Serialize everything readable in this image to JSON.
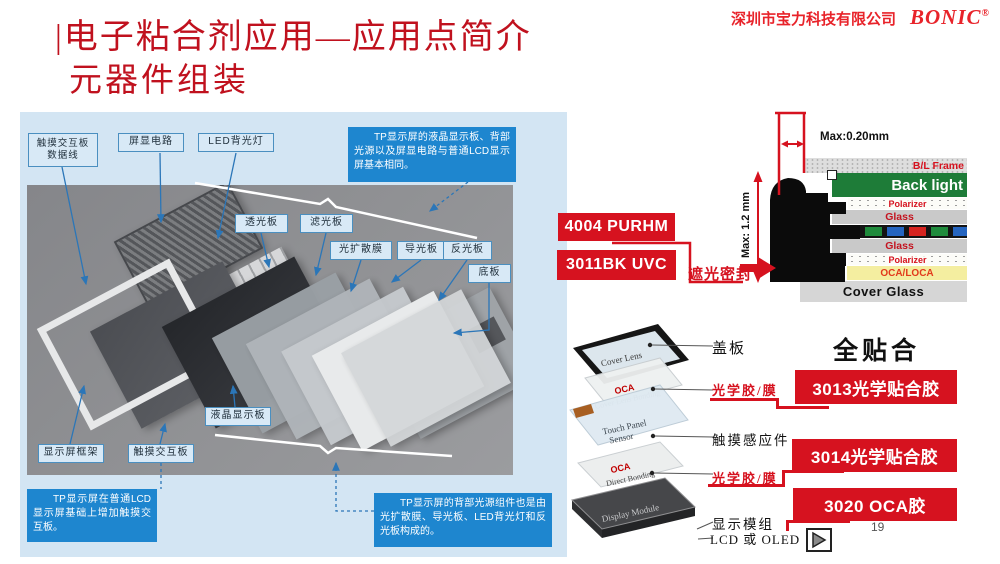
{
  "page": {
    "page_number": "19"
  },
  "header": {
    "company": "深圳市宝力科技有限公司",
    "brand": "BONIC",
    "reg": "®"
  },
  "title": {
    "line1": "|电子粘合剂应用—应用点简介",
    "line2": "元器件组装"
  },
  "photo_panel": {
    "labels": {
      "data_cable": "触摸交互板\n数据线",
      "screen_circuit": "屏显电路",
      "led_backlight": "LED背光灯",
      "light_trans": "透光板",
      "light_filter": "滤光板",
      "diffuser": "光扩散膜",
      "light_guide": "导光板",
      "reflector": "反光板",
      "base_plate": "底板",
      "lcd_panel": "液晶显示板",
      "frame": "显示屏框架",
      "touch_panel": "触摸交互板"
    },
    "callouts": {
      "top": "TP显示屏的液晶显示板、背部光源以及屏显电路与普通LCD显示屏基本相同。",
      "bottom_left": "TP显示屏在普通LCD显示屏基础上增加触摸交互板。",
      "bottom_right": "TP显示屏的背部光源组件也是由光扩散膜、导光板、LED背光灯和反光板构成的。"
    }
  },
  "stack_diagram": {
    "dim_top": "Max:0.20mm",
    "dim_side": "Max: 1.2 mm",
    "seal_label": "遮光密封",
    "products": [
      {
        "label": "4004 PURHM"
      },
      {
        "label": "3011BK UVC"
      }
    ],
    "layers": {
      "bl_frame": "B/L Frame",
      "backlight": "Back light",
      "polarizer_top": "Polarizer",
      "glass_top": "Glass",
      "glass_bottom": "Glass",
      "polarizer_bottom": "Polarizer",
      "oca": "OCA/LOCA",
      "cover_glass": "Cover Glass"
    }
  },
  "lamination_diagram": {
    "heading": "全贴合",
    "stack": {
      "cover_lens": "Cover Lens",
      "oca1_title": "OCA",
      "oca1_sub": "Cover Lens Bonding",
      "touch_line1": "Touch Panel",
      "touch_line2": "Sensor",
      "oca2_title": "OCA",
      "oca2_sub": "Direct Bonding",
      "display_module": "Display Module"
    },
    "labels": {
      "cover": "盖板",
      "optical1": "光学胶/膜",
      "touch": "触摸感应件",
      "optical2": "光学胶/膜",
      "display": "显示模组",
      "display_sub": "LCD 或 OLED"
    },
    "products": [
      {
        "label": "3013光学贴合胶"
      },
      {
        "label": "3014光学贴合胶"
      },
      {
        "label": "3020 OCA胶"
      }
    ]
  },
  "colors": {
    "accent_red": "#D6121F",
    "title_red": "#C0111E",
    "brand_red": "#E8232A",
    "callout_blue": "#1E86CF",
    "label_blue_bg": "#D8E9F6",
    "label_blue_border": "#4A8FC0",
    "backlight_green": "#1E7C38",
    "oca_yellow": "#F4EEA0"
  }
}
